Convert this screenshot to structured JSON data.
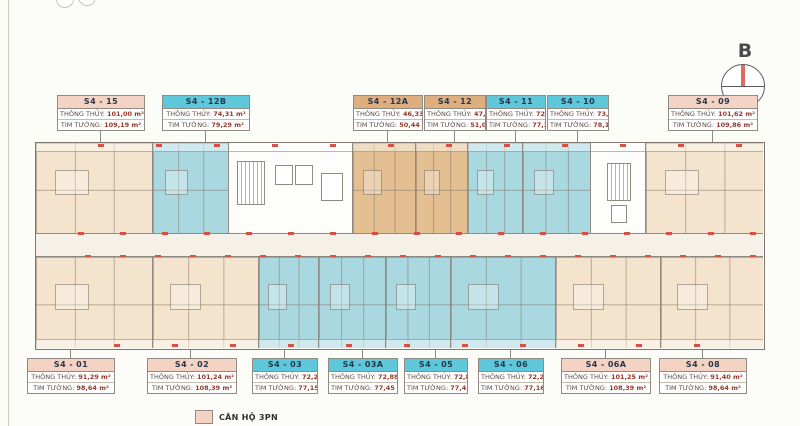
{
  "strings": {
    "net_label": "THÔNG THỦY:",
    "gross_label": "TIM TƯỜNG:"
  },
  "compass": {
    "label": "B"
  },
  "legend": {
    "label": "CĂN HỘ 3PN",
    "swatch_color": "#f5d3c4"
  },
  "colors": {
    "type_3pn_header": "#f5d3c4",
    "type_2pn_header": "#5ec7d9",
    "type_studio_header": "#dfae7e",
    "unit_cream": "#f4e4cd",
    "unit_blue": "#a9d8e0",
    "unit_tan": "#e3bf92",
    "accent_red": "#d94f43"
  },
  "top_units": [
    {
      "code": "S4 - 15",
      "type": "3pn",
      "net": "101,00 m²",
      "gross": "109,19 m²"
    },
    {
      "code": "S4 - 12B",
      "type": "2pn",
      "net": "74,31 m²",
      "gross": "79,29 m²"
    },
    {
      "code": "S4 - 12A",
      "type": "studio",
      "net": "46,33 m²",
      "gross": "50,44 m²"
    },
    {
      "code": "S4 - 12",
      "type": "studio",
      "net": "47,17 m²",
      "gross": "51,08 m²"
    },
    {
      "code": "S4 - 11",
      "type": "2pn",
      "net": "72,09 m²",
      "gross": "77,32 m²"
    },
    {
      "code": "S4 - 10",
      "type": "2pn",
      "net": "73,12 m²",
      "gross": "78,12 m²"
    },
    {
      "code": "S4 - 09",
      "type": "3pn",
      "net": "101,62 m²",
      "gross": "109,86 m²"
    }
  ],
  "bottom_units": [
    {
      "code": "S4 - 01",
      "type": "3pn",
      "net": "91,29 m²",
      "gross": "98,64 m²"
    },
    {
      "code": "S4 - 02",
      "type": "3pn",
      "net": "101,24 m²",
      "gross": "108,39 m²"
    },
    {
      "code": "S4 - 03",
      "type": "2pn",
      "net": "72,27 m²",
      "gross": "77,15 m²"
    },
    {
      "code": "S4 - 03A",
      "type": "2pn",
      "net": "72,88 m²",
      "gross": "77,45 m²"
    },
    {
      "code": "S4 - 05",
      "type": "2pn",
      "net": "72,88 m²",
      "gross": "77,45 m²"
    },
    {
      "code": "S4 - 06",
      "type": "2pn",
      "net": "72,25 m²",
      "gross": "77,16 m²"
    },
    {
      "code": "S4 - 06A",
      "type": "3pn",
      "net": "101,25 m²",
      "gross": "108,39 m²"
    },
    {
      "code": "S4 - 08",
      "type": "3pn",
      "net": "91,40 m²",
      "gross": "98,64 m²"
    }
  ]
}
